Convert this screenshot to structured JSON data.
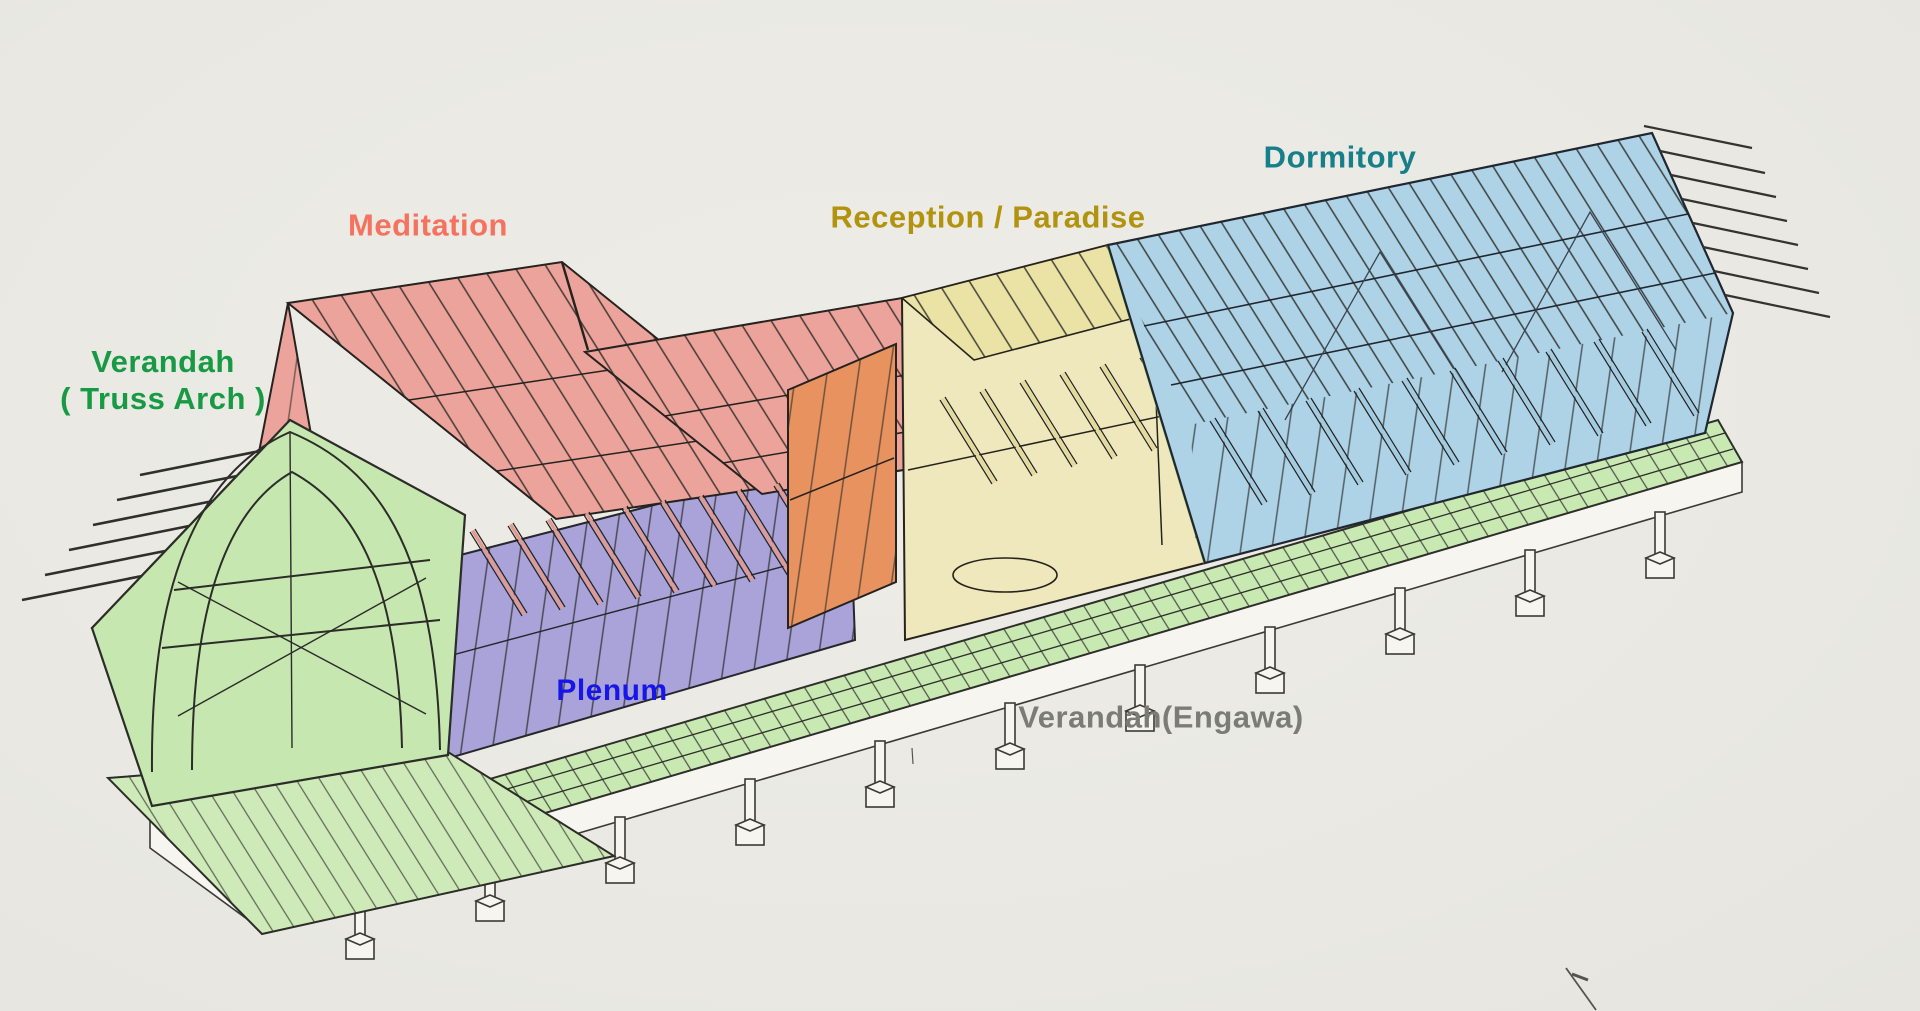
{
  "background_color": "#eae9e3",
  "labels": {
    "verandah_truss_arch": {
      "line1": "Verandah",
      "line2": "( Truss Arch )",
      "color": "#189a44"
    },
    "meditation": {
      "text": "Meditation",
      "color": "#f4725e"
    },
    "plenum": {
      "text": "Plenum",
      "color": "#1616e8"
    },
    "reception_paradise": {
      "text": "Reception / Paradise",
      "color": "#b2930d"
    },
    "dormitory": {
      "text": "Dormitory",
      "color": "#177f8a"
    },
    "verandah_engawa": {
      "text": "Verandah(Engawa)",
      "color": "#7c7c76"
    }
  },
  "zones": [
    {
      "name": "Verandah ( Truss Arch )",
      "fill": "#c6e7af"
    },
    {
      "name": "Meditation",
      "fill": "#eba39b"
    },
    {
      "name": "Plenum",
      "fill": "#aaa3d9"
    },
    {
      "name": "unlabeled-orange-gable-wall",
      "fill": "#e8935f"
    },
    {
      "name": "Reception / Paradise",
      "fill": "#ebe3a6"
    },
    {
      "name": "Dormitory",
      "fill": "#aed2e6"
    },
    {
      "name": "Verandah(Engawa) walkway",
      "fill": "#c9e9b3"
    }
  ]
}
